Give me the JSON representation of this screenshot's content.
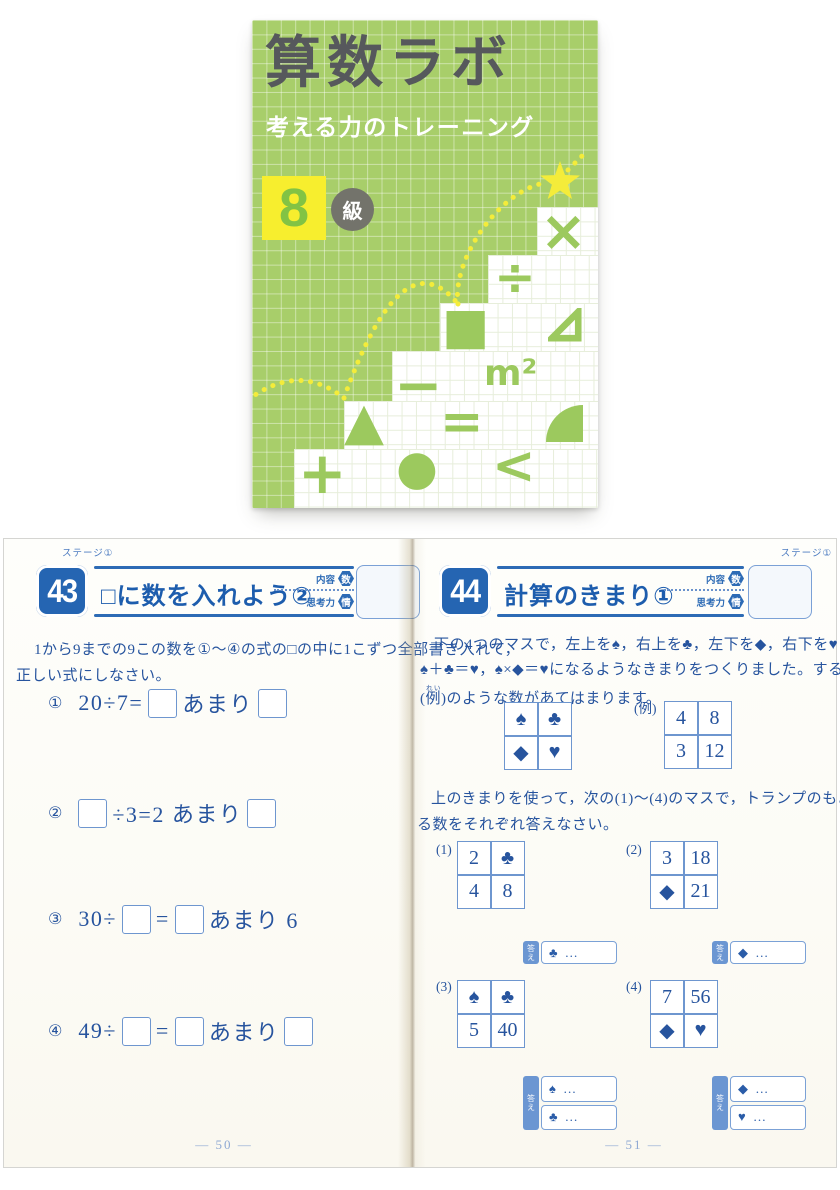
{
  "colors": {
    "cover_green": "#a8ce6a",
    "cover_yellow": "#f7ee2e",
    "grade_green": "#82c344",
    "badge_gray": "#73736b",
    "title_gray": "#56585c",
    "header_blue": "#2d6bb5",
    "text_blue": "#27549e",
    "light_blue_border": "#6e96cf"
  },
  "cover": {
    "title": "算数ラボ",
    "subtitle": "考える力のトレーニング",
    "grade_number": "8",
    "grade_suffix": "級",
    "symbols": {
      "multiply": "×",
      "divide": "÷",
      "filled_square": "■",
      "minus": "−",
      "m_squared": "m²",
      "filled_triangle": "▲",
      "equals": "=",
      "plus": "+",
      "filled_circle": "●",
      "less_than": "<"
    }
  },
  "spread": {
    "stage_label": "ステージ①",
    "meta": {
      "content_label": "内容",
      "content_badge": "数",
      "skill_label": "思考力",
      "skill_badge": "情"
    },
    "left_page": {
      "lesson_number": "43",
      "lesson_title": "□に数を入れよう②",
      "intro_line1": "1から9までの9この数を①～④の式の□の中に1こずつ全部書き入れて，",
      "intro_line2": "正しい式にしなさい。",
      "problems": [
        {
          "num": "①",
          "pre": "20÷7=",
          "mid": "あまり"
        },
        {
          "num": "②",
          "mid": "÷3=2 あまり"
        },
        {
          "num": "③",
          "pre": "30÷",
          "mid": "=",
          "post": "あまり 6"
        },
        {
          "num": "④",
          "pre": "49÷",
          "mid": "=",
          "post": "あまり"
        }
      ],
      "page_number": "— 50 —"
    },
    "right_page": {
      "lesson_number": "44",
      "lesson_title": "計算のきまり①",
      "intro_line1": "下の4つのマスで，左上を♠，右上を♣，左下を◆，右下を♥として，",
      "intro_line2": "♠＋♣＝♥，♠×◆＝♥になるようなきまりをつくりました。すると，右下の",
      "intro_line3_open": "(",
      "intro_ruby_base": "例",
      "intro_ruby_text": "れい",
      "intro_line3_rest": ")のような数があてはまります。",
      "rule_grid_cells": [
        "♠",
        "♣",
        "◆",
        "♥"
      ],
      "example_label": "(例)",
      "example_cells": [
        "4",
        "8",
        "3",
        "12"
      ],
      "instruction_line1": "上のきまりを使って，次の(1)～(4)のマスで，トランプのもようにあてはま",
      "instruction_line2": "る数をそれぞれ答えなさい。",
      "answer_label": "答え",
      "questions": [
        {
          "label": "(1)",
          "cells": [
            "2",
            "♣",
            "4",
            "8"
          ],
          "answers": [
            "♣ …"
          ]
        },
        {
          "label": "(2)",
          "cells": [
            "3",
            "18",
            "◆",
            "21"
          ],
          "answers": [
            "◆ …"
          ]
        },
        {
          "label": "(3)",
          "cells": [
            "♠",
            "♣",
            "5",
            "40"
          ],
          "answers": [
            "♠ …",
            "♣ …"
          ]
        },
        {
          "label": "(4)",
          "cells": [
            "7",
            "56",
            "◆",
            "♥"
          ],
          "answers": [
            "◆ …",
            "♥ …"
          ]
        }
      ],
      "page_number": "— 51 —"
    }
  }
}
